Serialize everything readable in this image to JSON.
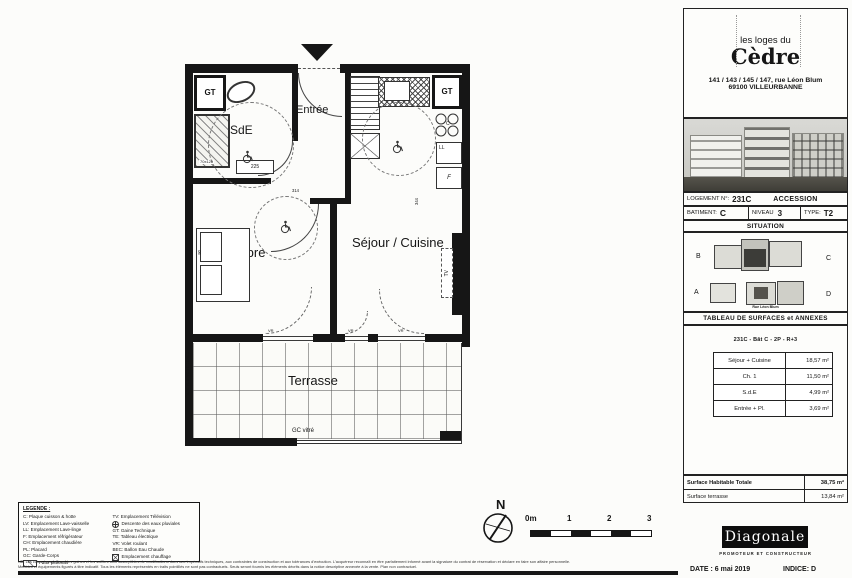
{
  "plan": {
    "rooms": {
      "sde": "SdE",
      "entree": "Entrée",
      "chambre": "Chambre",
      "sejour": "Séjour / Cuisine",
      "terrasse": "Terrasse"
    },
    "marks": {
      "gt": "GT",
      "ll": "LL",
      "f": "F",
      "hob": "C",
      "tv": "TV",
      "vr": "VR",
      "shower_size": "70x120",
      "radiator": "225",
      "dim_a": "314",
      "dim_b": "344",
      "dim_c": "90",
      "gc": "GC vitré",
      "pare_vue": "Pare vue verre opale"
    },
    "north": "N",
    "scale_ticks": [
      "0m",
      "1",
      "2",
      "3"
    ]
  },
  "legend": {
    "title": "LEGENDE :",
    "left": [
      "C: Plaque cuisson & hotte",
      "LV: Emplacement Lave-vaisselle",
      "LL: Emplacement Lave-linge",
      "F: Emplacement réfrigérateur",
      "CH: Emplacement chaudière",
      "PL: Placard",
      "GC: Garde-Corps",
      "Faux-plafonds"
    ],
    "right": [
      "TV: Emplacement Télévision",
      "Descente des eaux pluviales",
      "GT: Gaine Technique",
      "TE: Tableau électrique",
      "VR: Volet roulant",
      "BEC: Ballon Eau Chaude",
      "Emplacement chauffage"
    ]
  },
  "fine_print": {
    "line1": "NB: Les cotes, les surfaces, les gaines et les soffites sont susceptibles de modifications dues aux impératifs techniques, aux contraintes de construction et aux tolérances d'exécution. L'acquéreur reconnaît en être parfaitement informé avant la signature du contrat de réservation et déclare en faire son affaire personnelle.",
    "line2": "Meubles et équipements figurés à titre indicatif. Tous les éléments représentés en traits pointillés ne sont pas contractuels. Seuls seront fournis les éléments décrits dans la notice descriptive annexée à la vente. Plan non contractuel."
  },
  "title_block": {
    "brand": {
      "line1": "les loges du",
      "line2": "Cèdre",
      "address1": "141 / 143 / 145 / 147, rue Léon Blum",
      "address2": "69100 VILLEURBANNE"
    },
    "info": {
      "logement_label": "LOGEMENT N°:",
      "logement_value": "231C",
      "accession": "ACCESSION",
      "batiment_label": "BATIMENT:",
      "batiment_value": "C",
      "niveau_label": "NIVEAU",
      "niveau_value": "3",
      "type_label": "TYPE:",
      "type_value": "T2"
    },
    "situation": {
      "band": "SITUATION",
      "b": "B",
      "c": "C",
      "a": "A",
      "d": "D",
      "street": "Rue Léon Blum"
    },
    "surfaces": {
      "band": "TABLEAU DE SURFACES et ANNEXES",
      "subtitle": "231C - Bât C - 2P - R+3",
      "rows": [
        {
          "label": "Séjour + Cuisine",
          "value": "18,57 m²"
        },
        {
          "label": "Ch. 1",
          "value": "11,50 m²"
        },
        {
          "label": "S.d.E",
          "value": "4,99 m²"
        },
        {
          "label": "Entrée + Pl.",
          "value": "3,69 m²"
        }
      ],
      "totals": [
        {
          "label": "Surface Habitable Totale",
          "value": "38,75 m²"
        },
        {
          "label": "Surface terrasse",
          "value": "13,84 m²"
        }
      ]
    },
    "builder": {
      "name": "Diagonale",
      "tagline": "PROMOTEUR ET CONSTRUCTEUR"
    },
    "footer": {
      "date": "DATE : 6 mai 2019",
      "indice": "INDICE: D"
    }
  }
}
